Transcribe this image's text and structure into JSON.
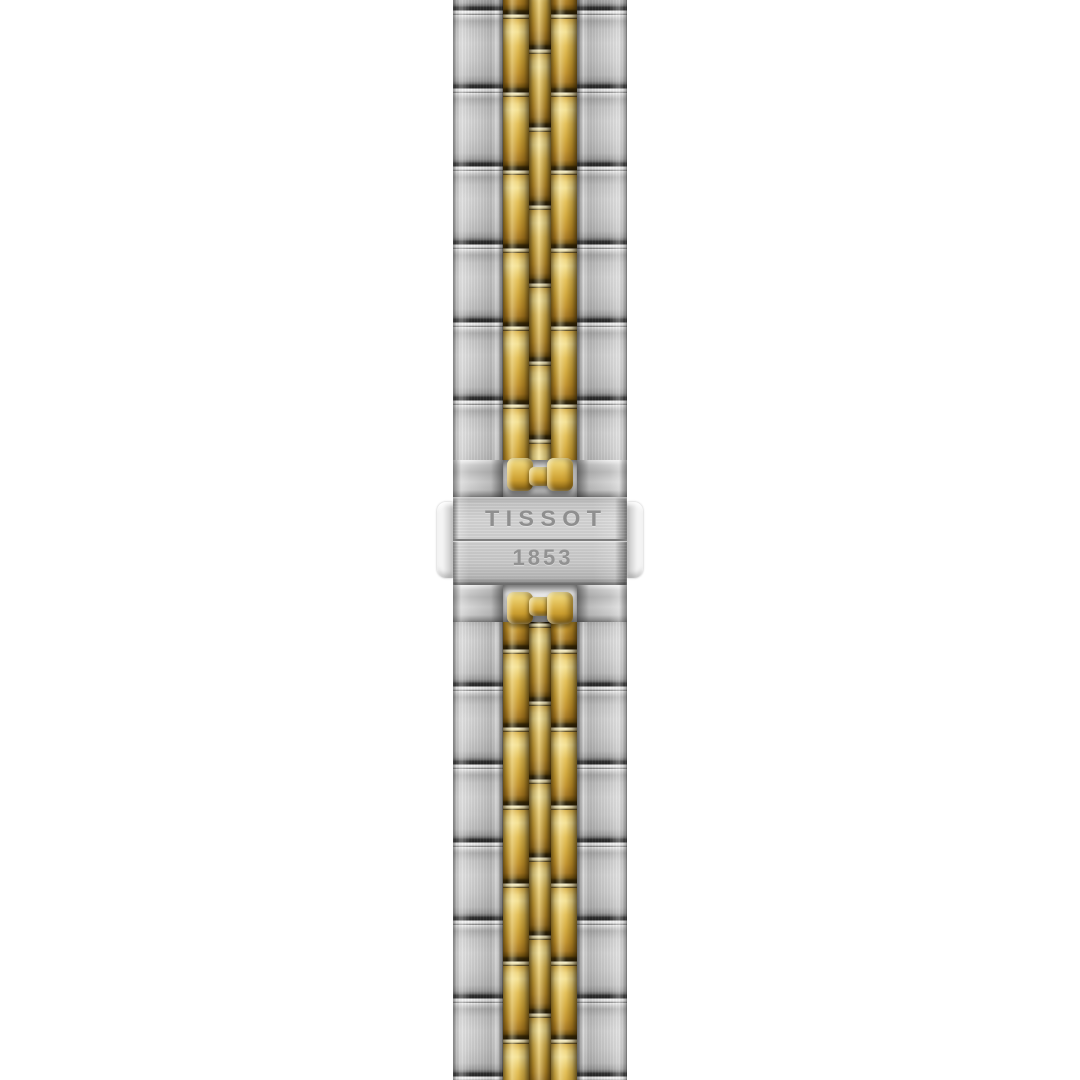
{
  "product": {
    "clasp": {
      "brand": "TISSOT",
      "year": "1853"
    }
  },
  "bracelet": {
    "style": "five-row two-tone jubilee bracelet, vertical on white background",
    "rows": [
      "steel",
      "gold",
      "gold",
      "gold",
      "steel"
    ]
  },
  "colors": {
    "background": "#ffffff",
    "steel_base": "#cccccc",
    "steel_highlight": "#f2f2f2",
    "steel_shadow": "#5f5f5f",
    "gold_base": "#d0a536",
    "gold_highlight": "#f4e193",
    "gold_shadow": "#3a2a06",
    "engraving": "#8f8f8f"
  }
}
